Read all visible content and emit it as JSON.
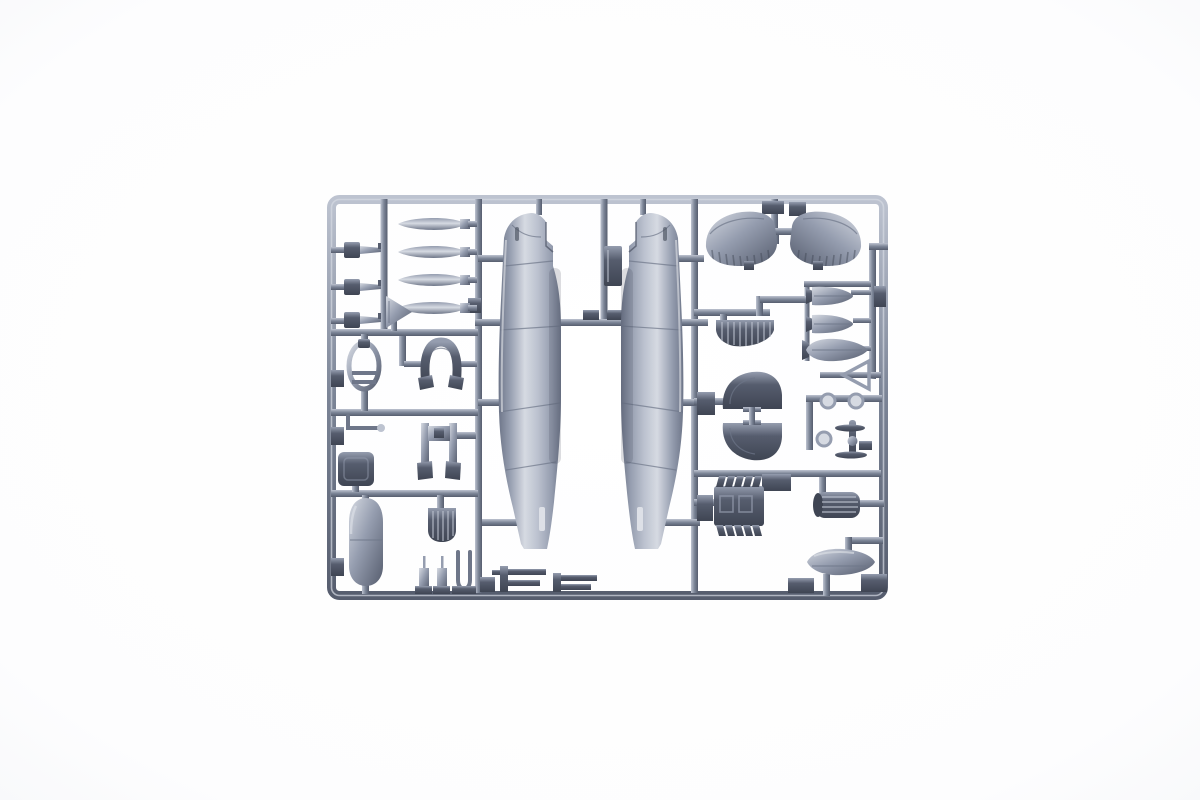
{
  "scene": {
    "title": "Plastic model kit sprue — grey styrene parts tree",
    "alt_text": "Product photograph of a grey injection-molded plastic model kit sprue on a white background, holding the parts of a WWII single-engine fighter aircraft: two vertical fuselage halves in the centre, four propeller blades and landing-gear parts on the left, stabilizer halves, flap, wheel hubs, engine block, exhaust manifold, two bombs, a fuel tank and a drop tank on the right, all attached to a rectangular runner frame.",
    "background_color": "#ffffff"
  },
  "sprue": {
    "colors": {
      "hi": "#d6dae2",
      "light": "#bdc3d0",
      "mid": "#959daf",
      "runner": "#7b8496",
      "shade": "#6e7689",
      "dark": "#565d6e",
      "darkest": "#3f4553",
      "slot": "#dde0e7",
      "background": "#ffffff"
    },
    "frame": {
      "left_px": 327,
      "top_px": 195,
      "right_px": 888,
      "bottom_px": 600
    },
    "parts": [
      {
        "id": "fuselage-half-left",
        "label": "Fuselage half, left side"
      },
      {
        "id": "fuselage-half-right",
        "label": "Fuselage half, right side"
      },
      {
        "id": "propeller-blade-1",
        "label": "Propeller blade"
      },
      {
        "id": "propeller-blade-2",
        "label": "Propeller blade"
      },
      {
        "id": "propeller-blade-3",
        "label": "Propeller blade"
      },
      {
        "id": "propeller-blade-4",
        "label": "Propeller blade"
      },
      {
        "id": "cannon-stub-part-1",
        "label": "Small cannon/exhaust stub"
      },
      {
        "id": "cannon-stub-part-2",
        "label": "Small cannon/exhaust stub"
      },
      {
        "id": "cannon-stub-part-3",
        "label": "Small cannon/exhaust stub"
      },
      {
        "id": "tailwheel-door-part",
        "label": "Triangular door part"
      },
      {
        "id": "oval-frame-part",
        "label": "Oval gear-leg frame"
      },
      {
        "id": "horseshoe-part",
        "label": "Horseshoe-shaped cowl part"
      },
      {
        "id": "pilot-seat",
        "label": "Pilot seat"
      },
      {
        "id": "wire-linkage-part",
        "label": "Bent wire linkage"
      },
      {
        "id": "landing-gear-struts",
        "label": "Landing gear struts"
      },
      {
        "id": "radiator-core-part",
        "label": "Ribbed radiator core"
      },
      {
        "id": "oil-cooler-fairing",
        "label": "Oil cooler fairing"
      },
      {
        "id": "gun-strut-parts",
        "label": "Small struts and fork"
      },
      {
        "id": "machine-gun-part-1",
        "label": "Machine gun"
      },
      {
        "id": "machine-gun-part-2",
        "label": "Machine gun"
      },
      {
        "id": "equipment-box-part",
        "label": "Equipment box"
      },
      {
        "id": "stabilizer-half-left",
        "label": "Stabilizer half"
      },
      {
        "id": "stabilizer-half-right",
        "label": "Stabilizer half"
      },
      {
        "id": "flap-part",
        "label": "Ribbed flap"
      },
      {
        "id": "wheel-fairing-upper",
        "label": "Wheel fairing half"
      },
      {
        "id": "wheel-fairing-lower",
        "label": "Wheel fairing half"
      },
      {
        "id": "wheel-hub-parts",
        "label": "Wheel hubs and small propeller"
      },
      {
        "id": "engine-block-part",
        "label": "Engine block with exhaust stubs"
      },
      {
        "id": "exhaust-manifold-part",
        "label": "Ribbed exhaust manifold"
      },
      {
        "id": "bomb-part-1",
        "label": "Bomb"
      },
      {
        "id": "bomb-part-2",
        "label": "Bomb"
      },
      {
        "id": "fuel-tank-part",
        "label": "Slipper fuel tank"
      },
      {
        "id": "pitot-triangle-part",
        "label": "Triangular frame part"
      },
      {
        "id": "drop-tank-part",
        "label": "Drop tank half"
      }
    ]
  }
}
